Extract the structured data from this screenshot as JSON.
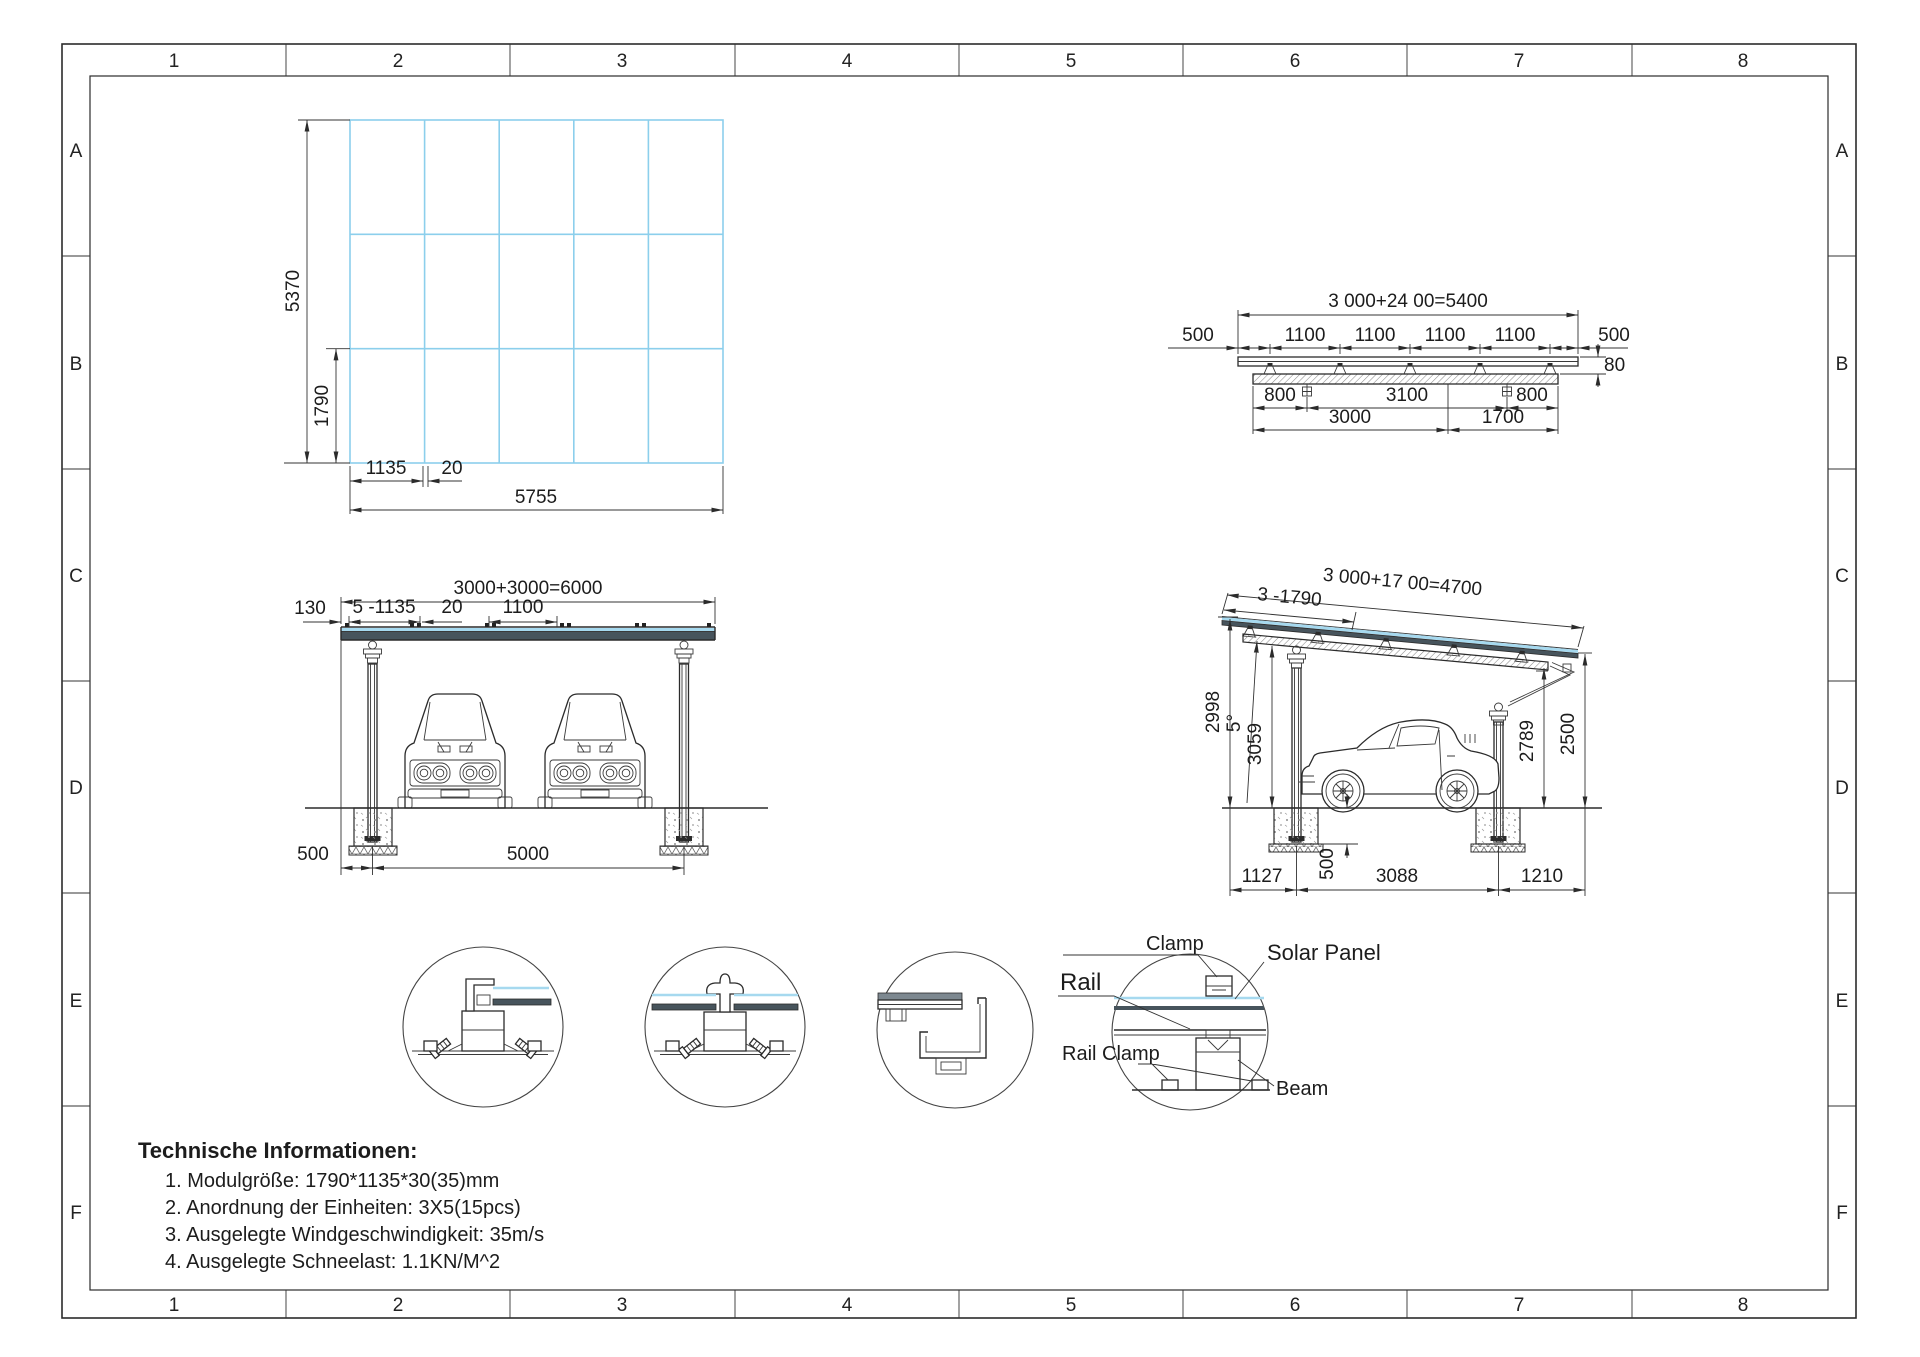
{
  "sheet": {
    "cols": [
      "1",
      "2",
      "3",
      "4",
      "5",
      "6",
      "7",
      "8"
    ],
    "rows": [
      "A",
      "B",
      "C",
      "D",
      "E",
      "F"
    ]
  },
  "plan_view": {
    "total_height": "5370",
    "module_height": "1790",
    "module_width": "1135",
    "gap": "20",
    "total_width": "5755"
  },
  "rail_view": {
    "total": "3 000+24 00=5400",
    "end_left": "500",
    "spacings": [
      "1100",
      "1100",
      "1100",
      "1100"
    ],
    "end_right": "500",
    "edge_height": "80",
    "bolt_left": "800",
    "bolt_mid": "3100",
    "bolt_right": "800",
    "seg_front": "3000",
    "seg_rear": "1700"
  },
  "front_view": {
    "total": "3000+3000=6000",
    "overhang": "130",
    "modules": "5 -1135",
    "gap": "20",
    "rail_spacing": "1100",
    "post_offset": "500",
    "span": "5000"
  },
  "side_view": {
    "total": "3 000+17 00=4700",
    "modules": "3 -1790",
    "front_height": "2998",
    "angle": "5°",
    "beam_height": "3059",
    "rear_beam_height": "2789",
    "rear_height": "2500",
    "front_offset": "1127",
    "footing_depth": "500",
    "span": "3088",
    "rear_offset": "1210"
  },
  "details": {
    "clamp": "Clamp",
    "solar_panel": "Solar Panel",
    "rail": "Rail",
    "rail_clamp": "Rail Clamp",
    "beam": "Beam"
  },
  "tech_info": {
    "title": "Technische Informationen:",
    "items": [
      "1. Modulgröße: 1790*1135*30(35)mm",
      "2. Anordnung der Einheiten: 3X5(15pcs)",
      "3. Ausgelegte Windgeschwindigkeit: 35m/s",
      "4. Ausgelegte Schneelast: 1.1KN/M^2"
    ]
  },
  "colors": {
    "panel_blue": "#a6d9ef",
    "grid_blue": "#8ccfec",
    "band_dark": "#47545c",
    "line": "#2b2b2b"
  }
}
